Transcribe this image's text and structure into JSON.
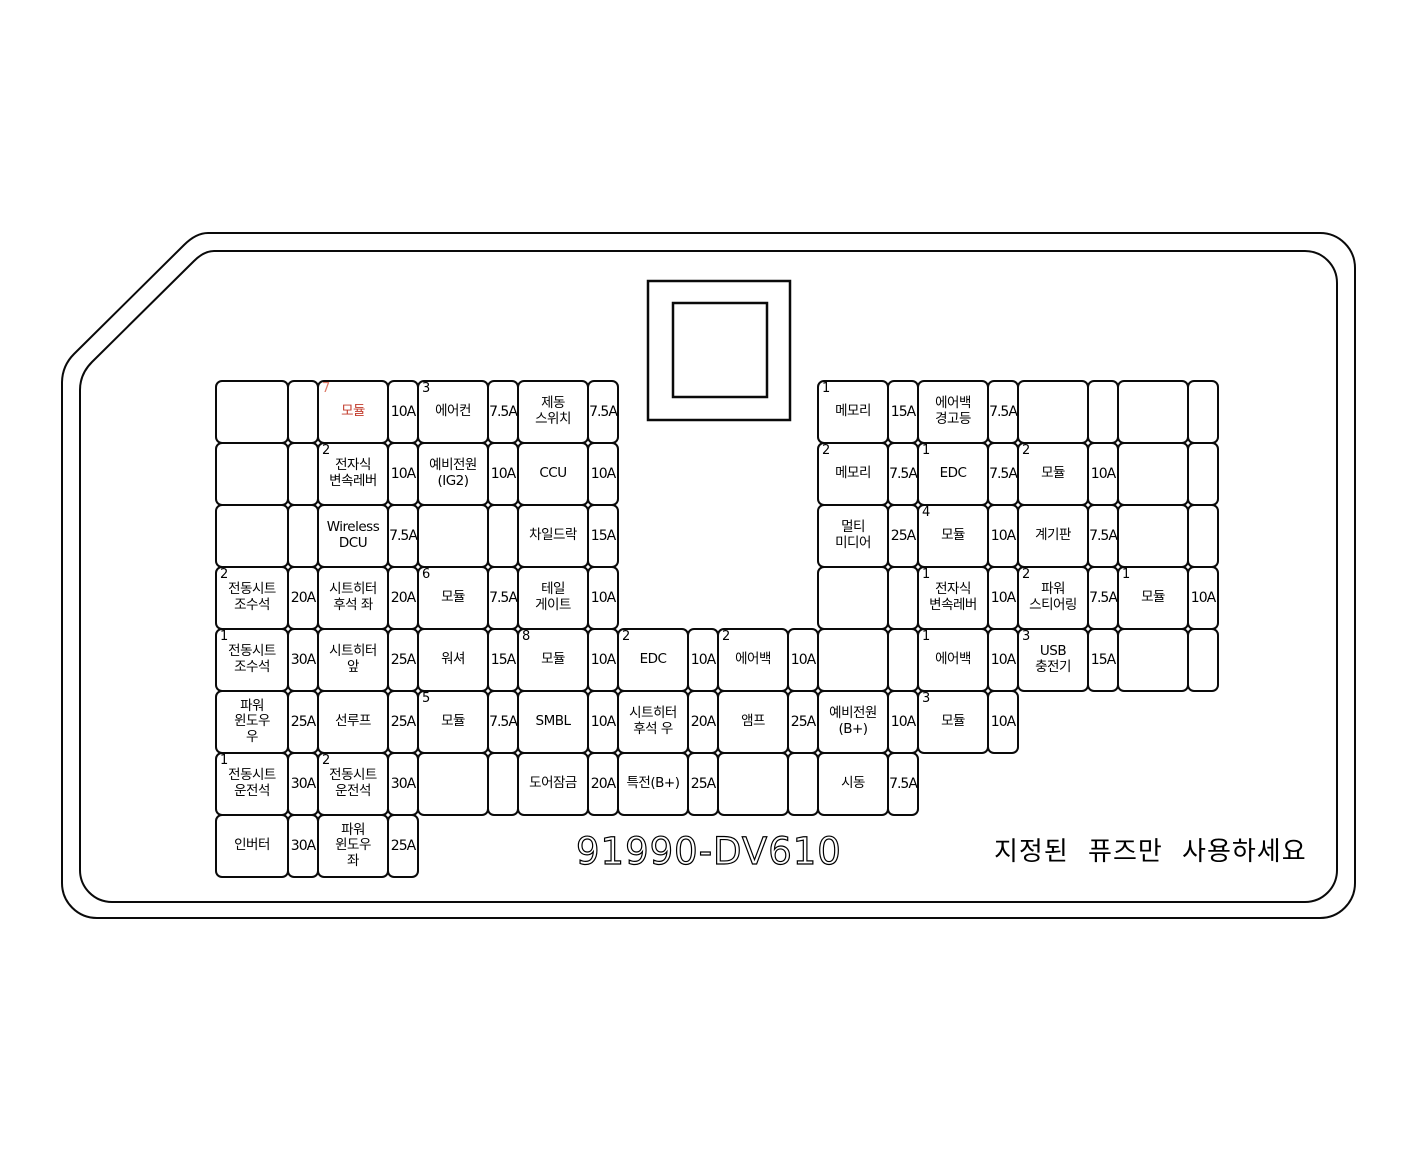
{
  "part_number": "91990-DV610",
  "notice": "지정된 퓨즈만 사용하세요",
  "colors": {
    "highlight": "#c23b2b",
    "highlight_light": "#dd7a68",
    "line": "#0a0a0a"
  },
  "grid": {
    "col_x": [
      215,
      317,
      417,
      517,
      617,
      717,
      817,
      917,
      1017,
      1117
    ],
    "amp_x": [
      287,
      387,
      487,
      587,
      687,
      787,
      887,
      987,
      1087,
      1187
    ],
    "amp_w": 30,
    "row_y": [
      380,
      442,
      504,
      566,
      628,
      690,
      752,
      814
    ],
    "row_h": 62
  },
  "fuses": [
    {
      "col": 0,
      "row": 0,
      "label": "",
      "amp": ""
    },
    {
      "col": 1,
      "row": 0,
      "idx": "7",
      "label": "모듈",
      "amp": "10A",
      "red": true
    },
    {
      "col": 2,
      "row": 0,
      "idx": "3",
      "label": "에어컨",
      "amp": "7.5A"
    },
    {
      "col": 3,
      "row": 0,
      "label": "제동\n스위치",
      "amp": "7.5A"
    },
    {
      "col": 6,
      "row": 0,
      "idx": "1",
      "label": "메모리",
      "amp": "15A"
    },
    {
      "col": 7,
      "row": 0,
      "label": "에어백\n경고등",
      "amp": "7.5A"
    },
    {
      "col": 8,
      "row": 0,
      "label": "",
      "amp": ""
    },
    {
      "col": 9,
      "row": 0,
      "label": "",
      "amp": ""
    },
    {
      "col": 0,
      "row": 1,
      "label": "",
      "amp": ""
    },
    {
      "col": 1,
      "row": 1,
      "idx": "2",
      "label": "전자식\n변속레버",
      "amp": "10A"
    },
    {
      "col": 2,
      "row": 1,
      "label": "예비전원\n(IG2)",
      "amp": "10A"
    },
    {
      "col": 3,
      "row": 1,
      "label": "CCU",
      "amp": "10A"
    },
    {
      "col": 6,
      "row": 1,
      "idx": "2",
      "label": "메모리",
      "amp": "7.5A"
    },
    {
      "col": 7,
      "row": 1,
      "idx": "1",
      "label": "EDC",
      "amp": "7.5A"
    },
    {
      "col": 8,
      "row": 1,
      "idx": "2",
      "label": "모듈",
      "amp": "10A"
    },
    {
      "col": 9,
      "row": 1,
      "label": "",
      "amp": ""
    },
    {
      "col": 0,
      "row": 2,
      "label": "",
      "amp": ""
    },
    {
      "col": 1,
      "row": 2,
      "label": "Wireless\nDCU",
      "amp": "7.5A"
    },
    {
      "col": 2,
      "row": 2,
      "label": "",
      "amp": ""
    },
    {
      "col": 3,
      "row": 2,
      "label": "차일드락",
      "amp": "15A"
    },
    {
      "col": 6,
      "row": 2,
      "label": "멀티\n미디어",
      "amp": "25A"
    },
    {
      "col": 7,
      "row": 2,
      "idx": "4",
      "label": "모듈",
      "amp": "10A"
    },
    {
      "col": 8,
      "row": 2,
      "label": "계기판",
      "amp": "7.5A"
    },
    {
      "col": 9,
      "row": 2,
      "label": "",
      "amp": ""
    },
    {
      "col": 0,
      "row": 3,
      "idx": "2",
      "label": "전동시트\n조수석",
      "amp": "20A"
    },
    {
      "col": 1,
      "row": 3,
      "label": "시트히터\n후석 좌",
      "amp": "20A"
    },
    {
      "col": 2,
      "row": 3,
      "idx": "6",
      "label": "모듈",
      "amp": "7.5A"
    },
    {
      "col": 3,
      "row": 3,
      "label": "테일\n게이트",
      "amp": "10A"
    },
    {
      "col": 6,
      "row": 3,
      "label": "",
      "amp": ""
    },
    {
      "col": 7,
      "row": 3,
      "idx": "1",
      "label": "전자식\n변속레버",
      "amp": "10A"
    },
    {
      "col": 8,
      "row": 3,
      "idx": "2",
      "label": "파워\n스티어링",
      "amp": "7.5A"
    },
    {
      "col": 9,
      "row": 3,
      "idx": "1",
      "label": "모듈",
      "amp": "10A"
    },
    {
      "col": 0,
      "row": 4,
      "idx": "1",
      "label": "전동시트\n조수석",
      "amp": "30A"
    },
    {
      "col": 1,
      "row": 4,
      "label": "시트히터\n앞",
      "amp": "25A"
    },
    {
      "col": 2,
      "row": 4,
      "label": "워셔",
      "amp": "15A"
    },
    {
      "col": 3,
      "row": 4,
      "idx": "8",
      "label": "모듈",
      "amp": "10A"
    },
    {
      "col": 4,
      "row": 4,
      "idx": "2",
      "label": "EDC",
      "amp": "10A"
    },
    {
      "col": 5,
      "row": 4,
      "idx": "2",
      "label": "에어백",
      "amp": "10A"
    },
    {
      "col": 6,
      "row": 4,
      "label": "",
      "amp": ""
    },
    {
      "col": 7,
      "row": 4,
      "idx": "1",
      "label": "에어백",
      "amp": "10A"
    },
    {
      "col": 8,
      "row": 4,
      "idx": "3",
      "label": "USB\n충전기",
      "amp": "15A"
    },
    {
      "col": 9,
      "row": 4,
      "label": "",
      "amp": ""
    },
    {
      "col": 0,
      "row": 5,
      "label": "파워\n윈도우\n우",
      "amp": "25A"
    },
    {
      "col": 1,
      "row": 5,
      "label": "선루프",
      "amp": "25A"
    },
    {
      "col": 2,
      "row": 5,
      "idx": "5",
      "label": "모듈",
      "amp": "7.5A"
    },
    {
      "col": 3,
      "row": 5,
      "label": "SMBL",
      "amp": "10A"
    },
    {
      "col": 4,
      "row": 5,
      "label": "시트히터\n후석 우",
      "amp": "20A"
    },
    {
      "col": 5,
      "row": 5,
      "label": "앰프",
      "amp": "25A"
    },
    {
      "col": 6,
      "row": 5,
      "label": "예비전원\n(B+)",
      "amp": "10A"
    },
    {
      "col": 7,
      "row": 5,
      "idx": "3",
      "label": "모듈",
      "amp": "10A"
    },
    {
      "col": 0,
      "row": 6,
      "idx": "1",
      "label": "전동시트\n운전석",
      "amp": "30A"
    },
    {
      "col": 1,
      "row": 6,
      "idx": "2",
      "label": "전동시트\n운전석",
      "amp": "30A"
    },
    {
      "col": 2,
      "row": 6,
      "label": "",
      "amp": ""
    },
    {
      "col": 3,
      "row": 6,
      "label": "도어잠금",
      "amp": "20A"
    },
    {
      "col": 4,
      "row": 6,
      "label": "특전(B+)",
      "amp": "25A"
    },
    {
      "col": 5,
      "row": 6,
      "label": "",
      "amp": ""
    },
    {
      "col": 6,
      "row": 6,
      "label": "시동",
      "amp": "7.5A"
    },
    {
      "col": 0,
      "row": 7,
      "label": "인버터",
      "amp": "30A"
    },
    {
      "col": 1,
      "row": 7,
      "label": "파워\n윈도우\n좌",
      "amp": "25A"
    }
  ]
}
